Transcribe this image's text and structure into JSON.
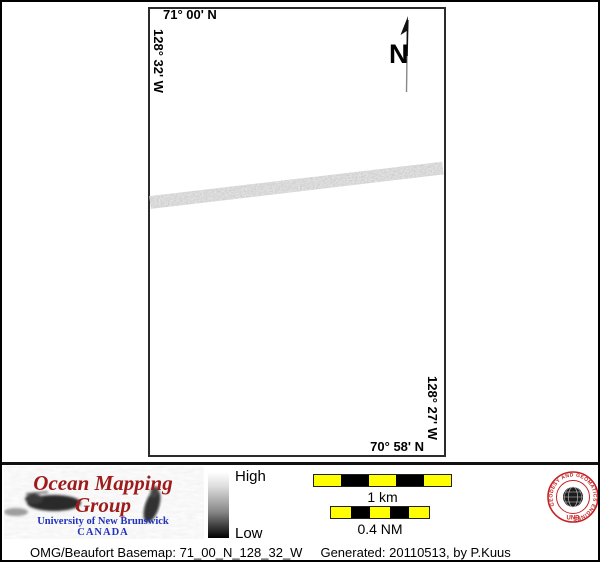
{
  "map": {
    "top_lat": "71° 00' N",
    "left_lon": "128° 32' W",
    "right_lon": "128° 27' W",
    "bottom_lat": "70° 58' N",
    "north_label": "N"
  },
  "colorbar": {
    "high": "High",
    "low": "Low"
  },
  "scalebars": {
    "km": {
      "label": "1 km",
      "segments": [
        "yellow",
        "black",
        "yellow",
        "black",
        "yellow"
      ]
    },
    "nm": {
      "label": "0.4 NM",
      "segments": [
        "yellow",
        "black",
        "yellow",
        "black",
        "yellow"
      ]
    }
  },
  "logo": {
    "title": "Ocean Mapping Group",
    "institution": "University of New Brunswick",
    "country": "CANADA"
  },
  "seal": {
    "ring_text": "GEODESY AND GEOMATICS ENGINEERING",
    "acronym": "UNB"
  },
  "footer": {
    "basemap": "OMG/Beaufort Basemap: 71_00_N_128_32_W",
    "generated": "Generated: 20110513, by P.Kuus"
  },
  "colors": {
    "scalebar_yellow": "#ffff00",
    "logo_title_red": "#9e1b1b",
    "unb_blue": "#2233bb",
    "seal_red": "#c42222"
  }
}
